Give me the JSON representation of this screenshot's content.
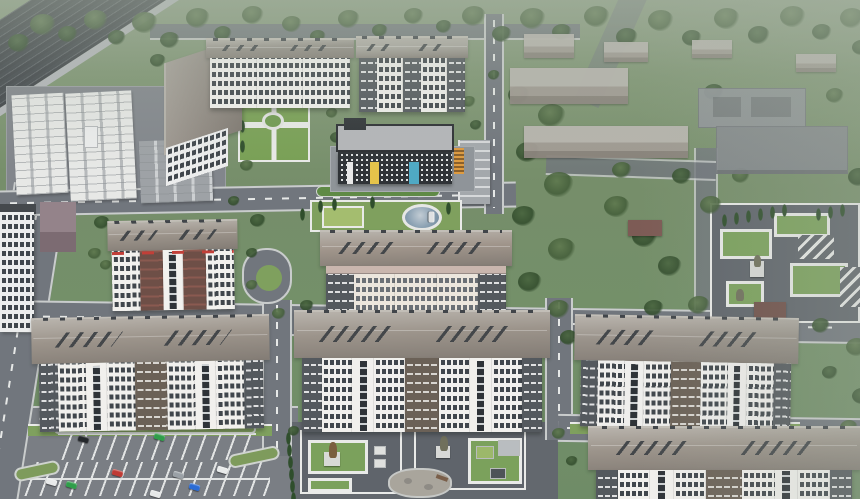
{
  "scene": {
    "type": "3d-aerial-architectural-render",
    "subject": "residential complex masterplan with apartment blocks, kindergarten, school, garages, parking lots and landscaped courtyards",
    "trees": [
      [
        8,
        34,
        22,
        0
      ],
      [
        30,
        14,
        26,
        1
      ],
      [
        58,
        26,
        20,
        0
      ],
      [
        84,
        10,
        24,
        1
      ],
      [
        108,
        30,
        18,
        0
      ],
      [
        132,
        12,
        26,
        1
      ],
      [
        160,
        32,
        20,
        0
      ],
      [
        186,
        8,
        24,
        1
      ],
      [
        214,
        26,
        18,
        0
      ],
      [
        242,
        6,
        22,
        1
      ],
      [
        150,
        54,
        16,
        0
      ],
      [
        282,
        16,
        20,
        1
      ],
      [
        310,
        30,
        16,
        0
      ],
      [
        338,
        10,
        22,
        1
      ],
      [
        372,
        24,
        16,
        0
      ],
      [
        404,
        8,
        20,
        1
      ],
      [
        436,
        20,
        16,
        0
      ],
      [
        462,
        6,
        24,
        1
      ],
      [
        492,
        26,
        20,
        0
      ],
      [
        520,
        8,
        26,
        1
      ],
      [
        552,
        24,
        20,
        0
      ],
      [
        584,
        6,
        26,
        1
      ],
      [
        616,
        28,
        22,
        0
      ],
      [
        648,
        10,
        26,
        1
      ],
      [
        682,
        30,
        20,
        0
      ],
      [
        714,
        8,
        26,
        1
      ],
      [
        748,
        26,
        22,
        0
      ],
      [
        780,
        6,
        26,
        1
      ],
      [
        812,
        24,
        20,
        0
      ],
      [
        840,
        8,
        24,
        1
      ],
      [
        852,
        40,
        18,
        0
      ],
      [
        508,
        86,
        22,
        0
      ],
      [
        538,
        104,
        28,
        1
      ],
      [
        516,
        142,
        24,
        0
      ],
      [
        544,
        172,
        30,
        1
      ],
      [
        512,
        206,
        24,
        0
      ],
      [
        548,
        238,
        28,
        1
      ],
      [
        518,
        272,
        24,
        0
      ],
      [
        548,
        300,
        22,
        1
      ],
      [
        582,
        318,
        18,
        0
      ],
      [
        604,
        196,
        26,
        1
      ],
      [
        632,
        226,
        26,
        0
      ],
      [
        612,
        162,
        20,
        1
      ],
      [
        658,
        256,
        24,
        0
      ],
      [
        688,
        296,
        22,
        1
      ],
      [
        644,
        300,
        20,
        0
      ],
      [
        700,
        196,
        22,
        1
      ],
      [
        672,
        168,
        20,
        0
      ],
      [
        732,
        168,
        18,
        1
      ],
      [
        704,
        84,
        20,
        0
      ],
      [
        826,
        88,
        18,
        1
      ],
      [
        848,
        168,
        22,
        0
      ],
      [
        94,
        216,
        16,
        0
      ],
      [
        88,
        248,
        14,
        1
      ],
      [
        250,
        214,
        16,
        0
      ],
      [
        104,
        318,
        14,
        1
      ],
      [
        78,
        344,
        16,
        0
      ],
      [
        272,
        308,
        14,
        1
      ],
      [
        560,
        330,
        18,
        0
      ],
      [
        300,
        300,
        14,
        0
      ],
      [
        240,
        160,
        14,
        1
      ],
      [
        228,
        196,
        12,
        0
      ],
      [
        100,
        260,
        12,
        1
      ],
      [
        246,
        248,
        12,
        0
      ],
      [
        246,
        280,
        12,
        1
      ],
      [
        748,
        318,
        20,
        1
      ],
      [
        812,
        318,
        18,
        0
      ],
      [
        846,
        338,
        22,
        1
      ],
      [
        852,
        388,
        20,
        0
      ],
      [
        840,
        420,
        18,
        1
      ],
      [
        822,
        366,
        16,
        0
      ],
      [
        288,
        426,
        12,
        0
      ],
      [
        552,
        428,
        14,
        1
      ],
      [
        566,
        456,
        12,
        0
      ],
      [
        330,
        132,
        14,
        0
      ],
      [
        326,
        108,
        12,
        1
      ],
      [
        470,
        120,
        12,
        0
      ],
      [
        462,
        96,
        14,
        1
      ],
      [
        488,
        70,
        12,
        0
      ],
      [
        330,
        64,
        14,
        1
      ],
      [
        300,
        60,
        12,
        0
      ],
      [
        248,
        92,
        0,
        2
      ],
      [
        258,
        90,
        0,
        2
      ],
      [
        268,
        88,
        0,
        2
      ],
      [
        278,
        86,
        0,
        2
      ],
      [
        290,
        84,
        0,
        2
      ],
      [
        300,
        88,
        0,
        2
      ],
      [
        240,
        120,
        0,
        2
      ],
      [
        240,
        140,
        0,
        2
      ],
      [
        318,
        200,
        0,
        2
      ],
      [
        332,
        198,
        0,
        2
      ],
      [
        300,
        208,
        0,
        2
      ],
      [
        446,
        202,
        0,
        2
      ],
      [
        370,
        196,
        0,
        2
      ],
      [
        286,
        432,
        0,
        2
      ],
      [
        287,
        444,
        0,
        2
      ],
      [
        288,
        456,
        0,
        2
      ],
      [
        289,
        468,
        0,
        2
      ],
      [
        290,
        480,
        0,
        2
      ],
      [
        291,
        492,
        0,
        2
      ],
      [
        722,
        214,
        0,
        2
      ],
      [
        734,
        212,
        0,
        2
      ],
      [
        746,
        210,
        0,
        2
      ],
      [
        758,
        208,
        0,
        2
      ],
      [
        770,
        206,
        0,
        2
      ],
      [
        782,
        204,
        0,
        2
      ],
      [
        816,
        208,
        0,
        2
      ],
      [
        828,
        206,
        0,
        2
      ],
      [
        840,
        204,
        0,
        2
      ]
    ],
    "cars": [
      [
        78,
        436,
        "#24272b",
        16
      ],
      [
        154,
        434,
        "#2f9e4a",
        16
      ],
      [
        112,
        470,
        "#bf3a34",
        16
      ],
      [
        46,
        479,
        "#e8eaea",
        16
      ],
      [
        66,
        482,
        "#2f9e4a",
        16
      ],
      [
        173,
        472,
        "#9aa0a6",
        16
      ],
      [
        189,
        484,
        "#2b6bd4",
        16
      ],
      [
        217,
        467,
        "#e8eaea",
        16
      ],
      [
        150,
        491,
        "#e6e8e8",
        16
      ],
      [
        426,
        214,
        "#dfe1e2",
        90
      ]
    ],
    "blocks": [
      {
        "name": "building-top-L-right-wing",
        "x": 206,
        "y": 38,
        "w": 148,
        "roof": 20,
        "fh": 50,
        "rot": 0,
        "base": "#f3f2ef",
        "roofc": "#938d86",
        "pattern": [
          "win",
          "win",
          "win"
        ],
        "accent": ""
      },
      {
        "name": "building-north",
        "x": 356,
        "y": 36,
        "w": 112,
        "roof": 22,
        "fh": 54,
        "rot": 0,
        "base": "#f1f0ed",
        "roofc": "#aaa69f",
        "pattern": [
          "dark",
          "win",
          "dark",
          "win",
          "dark"
        ],
        "accent": ""
      },
      {
        "name": "building-west-red",
        "x": 108,
        "y": 220,
        "w": 130,
        "roof": 30,
        "fh": 60,
        "rot": -1,
        "base": "#f2f1ee",
        "roofc": "#9c948b",
        "pattern": [
          "win",
          "brown",
          "slot",
          "brown",
          "win"
        ],
        "accent": "red-top"
      },
      {
        "name": "building-center",
        "x": 320,
        "y": 230,
        "w": 192,
        "roof": 36,
        "fh": 48,
        "rot": 0,
        "base": "#ece6dd",
        "roofc": "#a0958b",
        "winc": "#6b7076",
        "pattern": [
          "dark",
          "win",
          "win",
          "win",
          "dark"
        ],
        "accent": "pink-top"
      },
      {
        "name": "apartment-block-sw",
        "x": 32,
        "y": 316,
        "w": 238,
        "roof": 46,
        "fh": 68,
        "rot": -1,
        "base": "#f1f0ed",
        "roofc": "#9c948b",
        "pattern": [
          "dark",
          "win",
          "slot",
          "win",
          "cdark",
          "win",
          "slot",
          "win",
          "dark"
        ],
        "accent": ""
      },
      {
        "name": "apartment-block-s",
        "x": 294,
        "y": 310,
        "w": 256,
        "roof": 48,
        "fh": 74,
        "rot": 0,
        "base": "#f1f0ed",
        "roofc": "#9c948b",
        "pattern": [
          "dark",
          "win",
          "slot",
          "win",
          "cdark",
          "win",
          "slot",
          "win",
          "dark"
        ],
        "accent": ""
      },
      {
        "name": "apartment-block-se",
        "x": 574,
        "y": 316,
        "w": 224,
        "roof": 46,
        "fh": 66,
        "rot": 1,
        "base": "#efeeec",
        "roofc": "#9a938b",
        "pattern": [
          "dark",
          "win",
          "slot",
          "win",
          "cdark",
          "win",
          "slot",
          "win",
          "dark"
        ],
        "accent": ""
      },
      {
        "name": "apartment-block-far-se",
        "x": 588,
        "y": 426,
        "w": 272,
        "roof": 44,
        "fh": 30,
        "rot": 0,
        "base": "#f1f0ed",
        "roofc": "#9c948b",
        "pattern": [
          "dark",
          "win",
          "slot",
          "win",
          "cdark",
          "win",
          "slot",
          "win",
          "dark"
        ],
        "accent": ""
      }
    ]
  },
  "palette": {
    "road": "#71767d",
    "curb": "#c9cccc",
    "marking": "#e6e8e7",
    "win": "#40464c",
    "wall": "#f1f0ed",
    "lawn": "#7fa05e",
    "plaza": "#5f646b",
    "path": "#e9eae8",
    "grass": "#76906a",
    "tree_dark": "#34503a",
    "roof_warm": "#9c948b",
    "roof_flat": "#84888d",
    "kindergarten_dark": "#2f3337",
    "accent_yellow": "#e5c34a",
    "accent_teal": "#4fa9c4",
    "accent_orange": "#de9b40",
    "accent_red": "#c23f38",
    "fountain_blue": "#8aa0b2",
    "railway_dark": "#3e4247",
    "car_blue": "#2b6bd4",
    "car_red": "#bf3a34",
    "car_green": "#2f9e4a"
  }
}
